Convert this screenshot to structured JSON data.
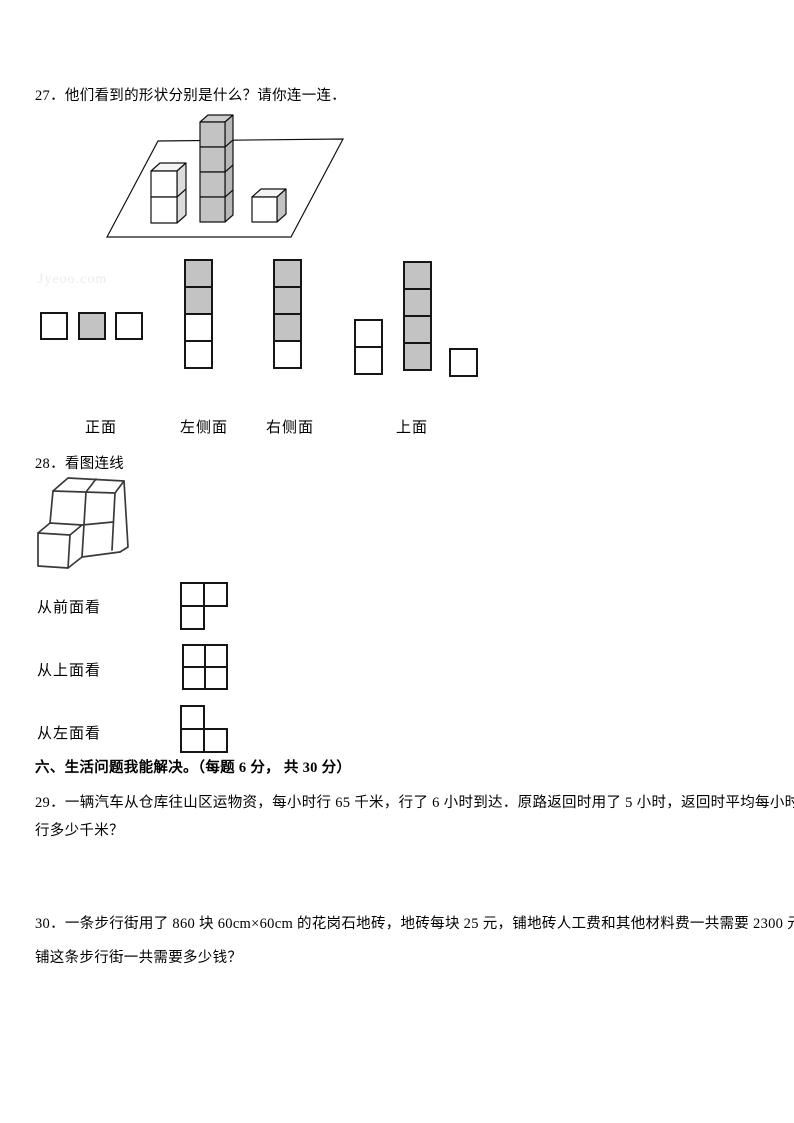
{
  "watermark": {
    "text": "Jyeoo.com"
  },
  "colors": {
    "gray_fill": "#c3c3c3",
    "line": "#161616"
  },
  "q27": {
    "title": "27．他们看到的形状分别是什么？请你连一连．",
    "solid": {
      "type": "cube-stacks-on-plane",
      "stack_heights": [
        2,
        4,
        1
      ],
      "shaded_stack": "middle"
    },
    "labels": {
      "front": "正面",
      "left_side": "左侧面",
      "right_side": "右侧面",
      "top": "上面"
    },
    "shapes": {
      "row3": {
        "cells": [
          {
            "c": 0,
            "r": 0,
            "gray": false
          },
          {
            "c": 1,
            "r": 0,
            "gray": true
          },
          {
            "c": 2,
            "r": 0,
            "gray": false
          }
        ]
      },
      "col4_a": {
        "cells": [
          {
            "c": 0,
            "r": 0,
            "gray": true
          },
          {
            "c": 0,
            "r": 1,
            "gray": true
          },
          {
            "c": 0,
            "r": 2,
            "gray": false
          },
          {
            "c": 0,
            "r": 3,
            "gray": false
          }
        ]
      },
      "col4_b": {
        "cells": [
          {
            "c": 0,
            "r": 0,
            "gray": true
          },
          {
            "c": 0,
            "r": 1,
            "gray": true
          },
          {
            "c": 0,
            "r": 2,
            "gray": true
          },
          {
            "c": 0,
            "r": 3,
            "gray": false
          }
        ]
      },
      "group_col2": {
        "cells": [
          {
            "c": 0,
            "r": 0,
            "gray": false
          },
          {
            "c": 0,
            "r": 1,
            "gray": false
          }
        ]
      },
      "group_col4": {
        "cells": [
          {
            "c": 0,
            "r": 0,
            "gray": true
          },
          {
            "c": 0,
            "r": 1,
            "gray": true
          },
          {
            "c": 0,
            "r": 2,
            "gray": true
          },
          {
            "c": 0,
            "r": 3,
            "gray": true
          }
        ]
      },
      "group_single": {
        "cells": [
          {
            "c": 0,
            "r": 0,
            "gray": false
          }
        ]
      }
    }
  },
  "q28": {
    "title": "28．看图连线",
    "rows": [
      {
        "label": "从前面看",
        "cells": [
          {
            "c": 0,
            "r": 0
          },
          {
            "c": 1,
            "r": 0
          },
          {
            "c": 0,
            "r": 1
          }
        ]
      },
      {
        "label": "从上面看",
        "cells": [
          {
            "c": 0,
            "r": 0
          },
          {
            "c": 1,
            "r": 0
          },
          {
            "c": 0,
            "r": 1
          },
          {
            "c": 1,
            "r": 1
          }
        ]
      },
      {
        "label": "从左面看",
        "cells": [
          {
            "c": 0,
            "r": 0
          },
          {
            "c": 0,
            "r": 1
          },
          {
            "c": 1,
            "r": 1
          }
        ]
      }
    ]
  },
  "section6": {
    "heading": "六、生活问题我能解决。（每题 6 分， 共 30 分）"
  },
  "q29": {
    "lines": [
      "29．一辆汽车从仓库往山区运物资，每小时行 65 千米，行了 6 小时到达．原路返回时用了 5 小时，返回时平均每小时",
      "行多少千米？"
    ]
  },
  "q30": {
    "lines": [
      "30．一条步行街用了 860 块 60cm×60cm 的花岗石地砖，地砖每块 25 元，铺地砖人工费和其他材料费一共需要 2300 元。",
      "铺这条步行街一共需要多少钱？"
    ]
  }
}
